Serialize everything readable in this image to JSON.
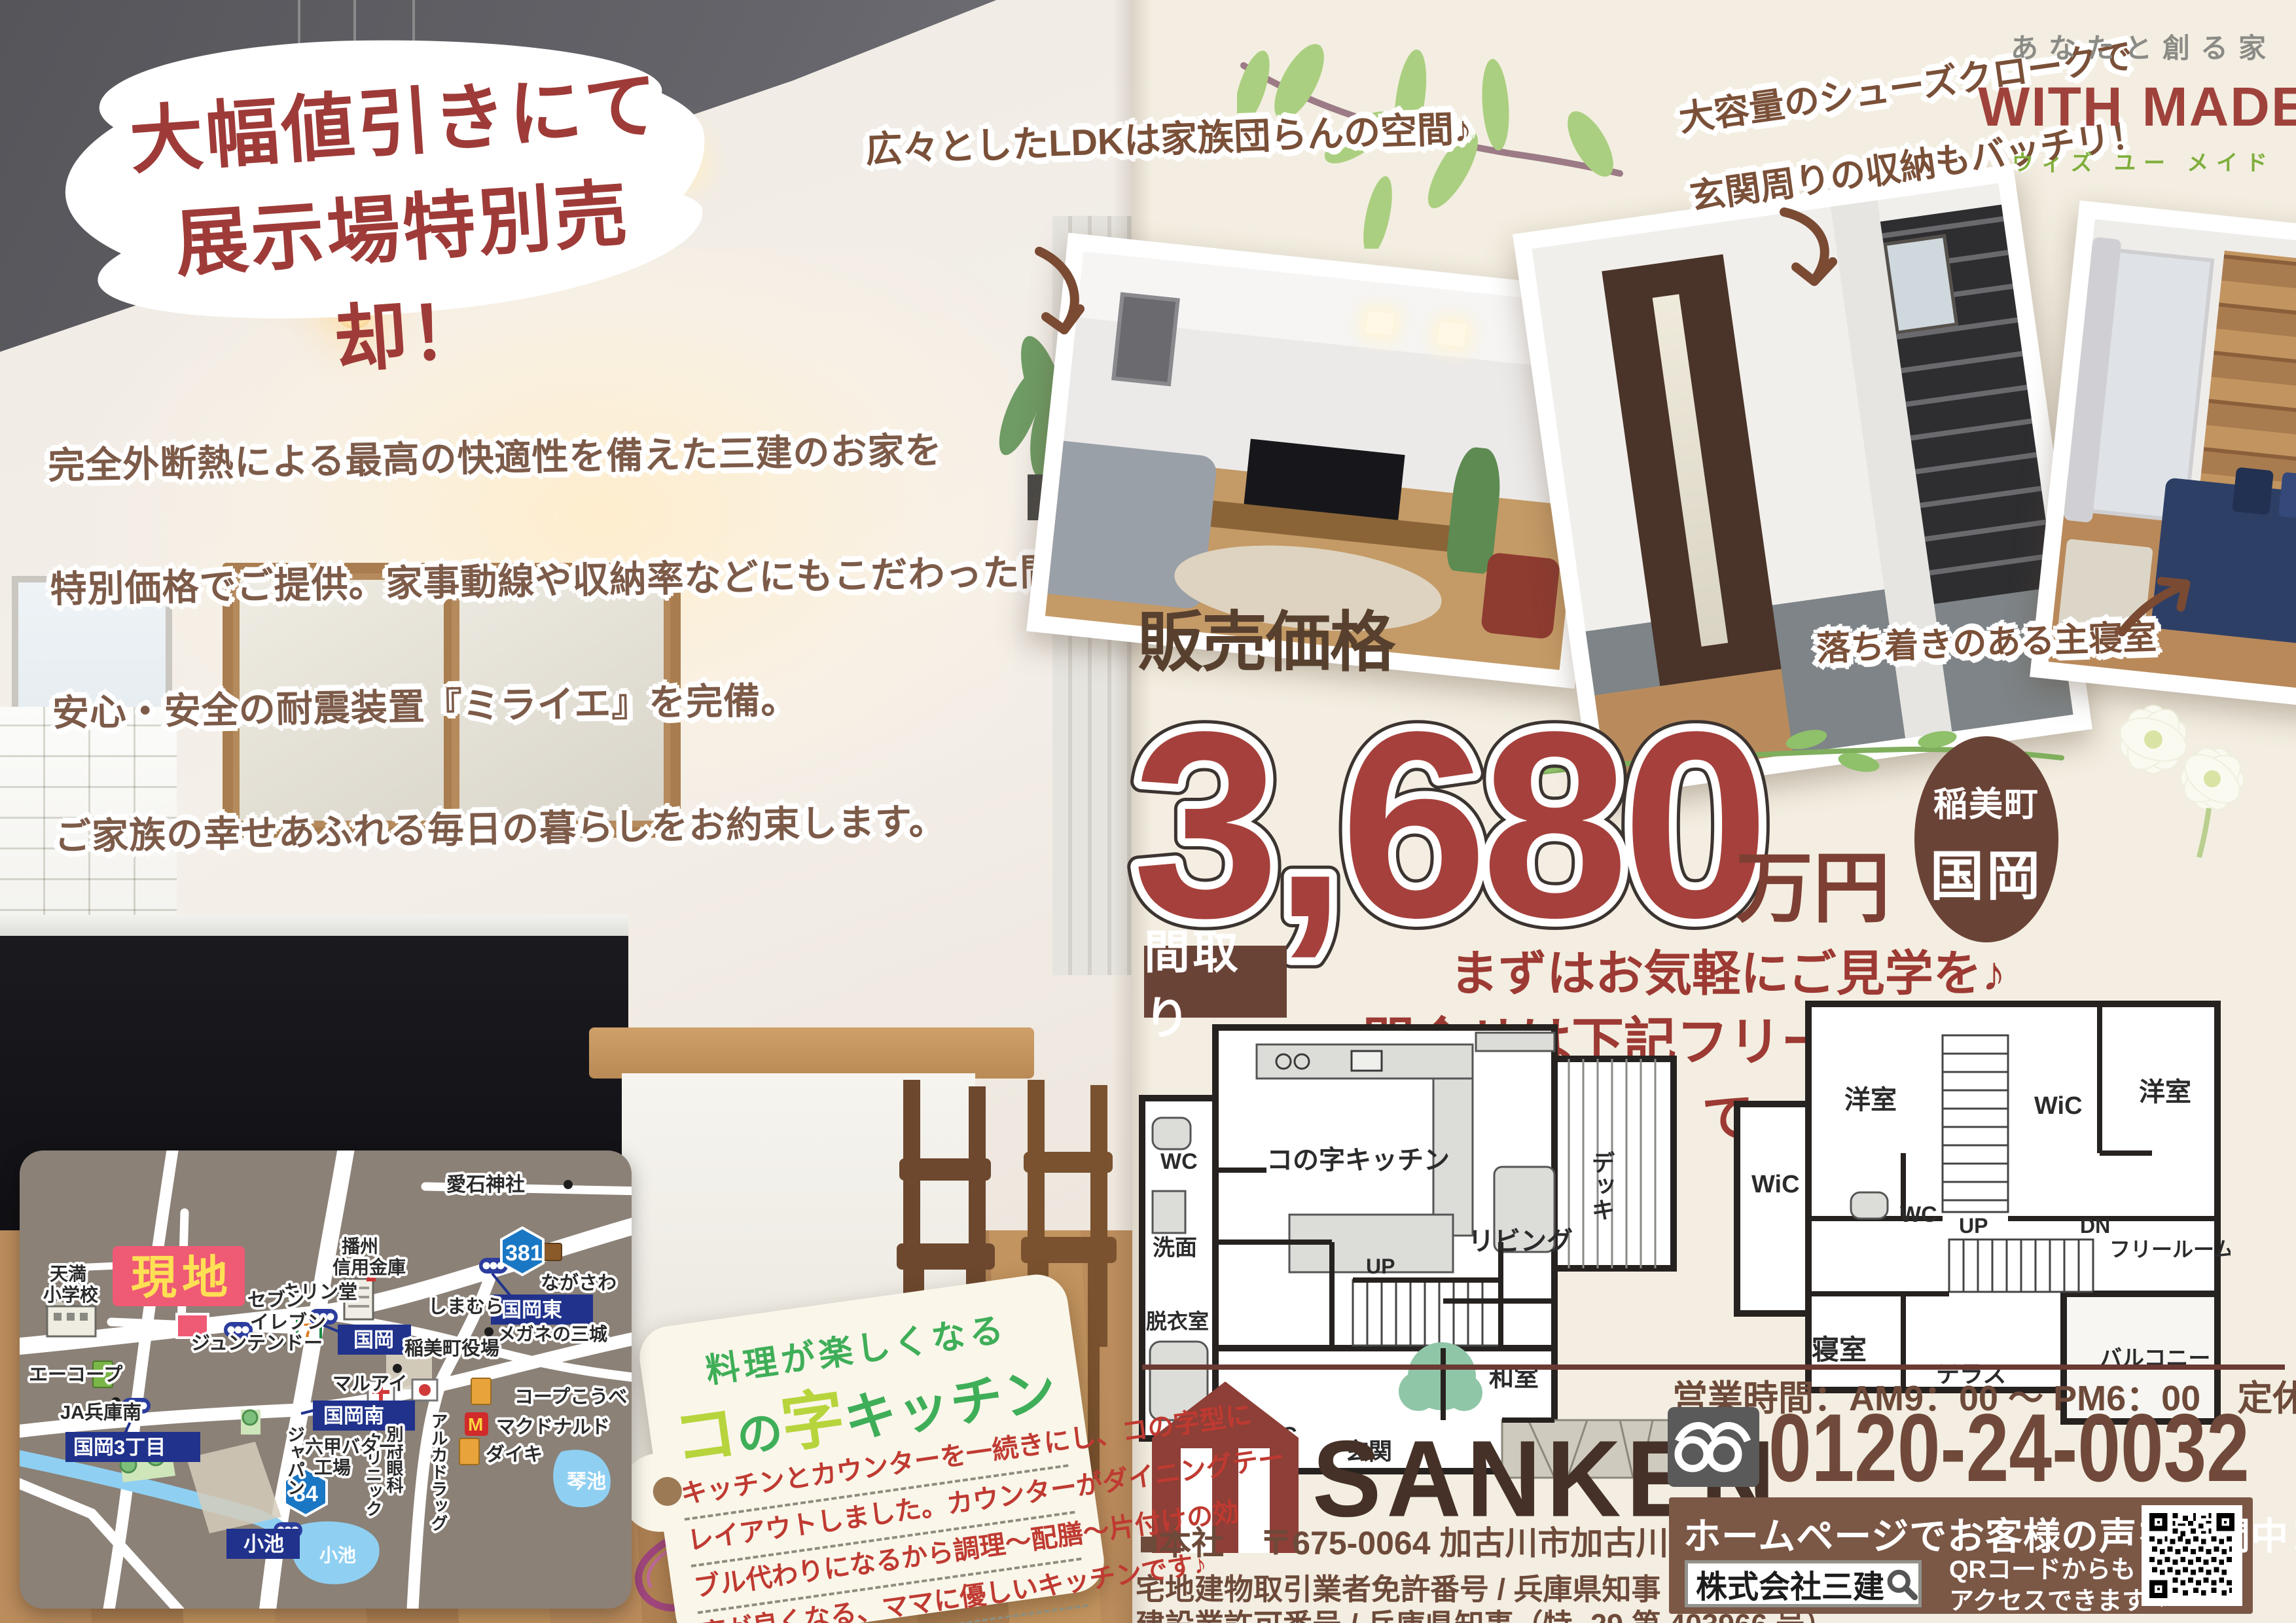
{
  "banner": {
    "line1": "大幅値引きにて",
    "line2": "展示場特別売却！"
  },
  "copy": {
    "line1": "完全外断熱による最高の快適性を備えた三建のお家を",
    "line2": "特別価格でご提供。家事動線や収納率などにもこだわった間取りに",
    "line3": "安心・安全の耐震装置『ミライエ』を完備。",
    "line4": "ご家族の幸せあふれる毎日の暮らしをお約束します。"
  },
  "captions": {
    "ldk": "広々としたLDKは家族団らんの空間♪",
    "shoes1": "大容量のシューズクロークで",
    "shoes2": "玄関周りの収納もバッチリ！",
    "bedroom": "落ち着きのある主寝室"
  },
  "brand": {
    "tagline": "あなたと創る家",
    "with": "WITH",
    "made": "MADE",
    "kana": "ウィズ ユー メイド"
  },
  "price": {
    "label": "販売価格",
    "amount": "3,680",
    "unit": "万円",
    "badge_line1": "稲美町",
    "badge_line2": "国岡",
    "cta1": "まずはお気軽にご見学を♪",
    "cta2": "問合せは下記フリーダイヤルまで"
  },
  "floorplan": {
    "label": "間取り",
    "f1": {
      "kitchen": "コの字キッチン",
      "living": "リビング",
      "deck": "デッキ",
      "wc": "WC",
      "wash": "洗面",
      "dressing": "脱衣室",
      "up": "UP",
      "sic": "SiC",
      "entrance": "玄関",
      "washitsu": "和室"
    },
    "f2": {
      "yoshitsu1": "洋室",
      "wic1": "WiC",
      "yoshitsu2": "洋室",
      "wic2": "WiC",
      "wc": "WC",
      "up": "UP",
      "dn": "DN",
      "freeroom": "フリールーム",
      "bedroom": "寝室",
      "terrace": "テラス",
      "balcony": "バルコニー"
    }
  },
  "tag": {
    "heading": "料理が楽しくなる",
    "t1": "コ",
    "t2": "の",
    "t3": "字",
    "t4": "キッチン",
    "body1": "キッチンとカウンターを一続きにし、コの字型に",
    "body2": "レイアウトしました。カウンターがダイニングテー",
    "body3": "ブル代わりになるから調理～配膳～片付けの効",
    "body4": "率が良くなる、ママに優しいキッチンです♪"
  },
  "map": {
    "genchi": "現地",
    "sign_kunioka": "国岡",
    "sign_kunioka_higashi": "国岡東",
    "sign_kunioka_minami": "国岡南",
    "sign_kunioka3": "国岡3丁目",
    "sign_koike": "小池",
    "route381": "381",
    "route84": "84",
    "pond_kotoike": "琴池",
    "pond_koike": "小池",
    "labels": {
      "aishi": "愛石神社",
      "tenma1": "天満",
      "tenma2": "小学校",
      "banshu1": "播州",
      "banshu2": "信用金庫",
      "kirindo": "キリン堂",
      "seven1": "セブン",
      "seven2": "イレブン",
      "shimamura": "しまむら",
      "nagasawa": "ながさわ",
      "megane": "メガネの三城",
      "yakuba": "稲美町役場",
      "junten": "ジュンテンドー",
      "maruai": "マルアイ",
      "coop": "コープこうべ",
      "mcdonalds": "マクドナルド",
      "daiki": "ダイキ",
      "beppu1": "別府眼科",
      "beppu2": "クリニック",
      "aruka": "アルカドラッグ",
      "rokko1": "六甲バター",
      "rokko2": "工場",
      "japan": "ジャパン",
      "ja": "JA兵庫南",
      "acoop": "エーコープ"
    }
  },
  "footer": {
    "hours": "営業時間：AM9：00 ～ PM6：00",
    "holiday": "定休日：毎火曜・水曜",
    "phone": "0120-24-0032",
    "company": "SANKEN",
    "hq_label": "■本社",
    "hq_address": "〒675-0064 加古川市加古川町溝之口 584 番地",
    "license1": "宅地建物取引業者免許番号 / 兵庫県知事 (11) 第 400166 号",
    "license2": "建設業許可番号 / 兵庫県知事（特 -29 第 403966 号）",
    "hp": "ホームページでお客様の声を公開中！",
    "search": "株式会社三建",
    "qr1": "QRコードからも",
    "qr2": "アクセスできます⇒"
  }
}
